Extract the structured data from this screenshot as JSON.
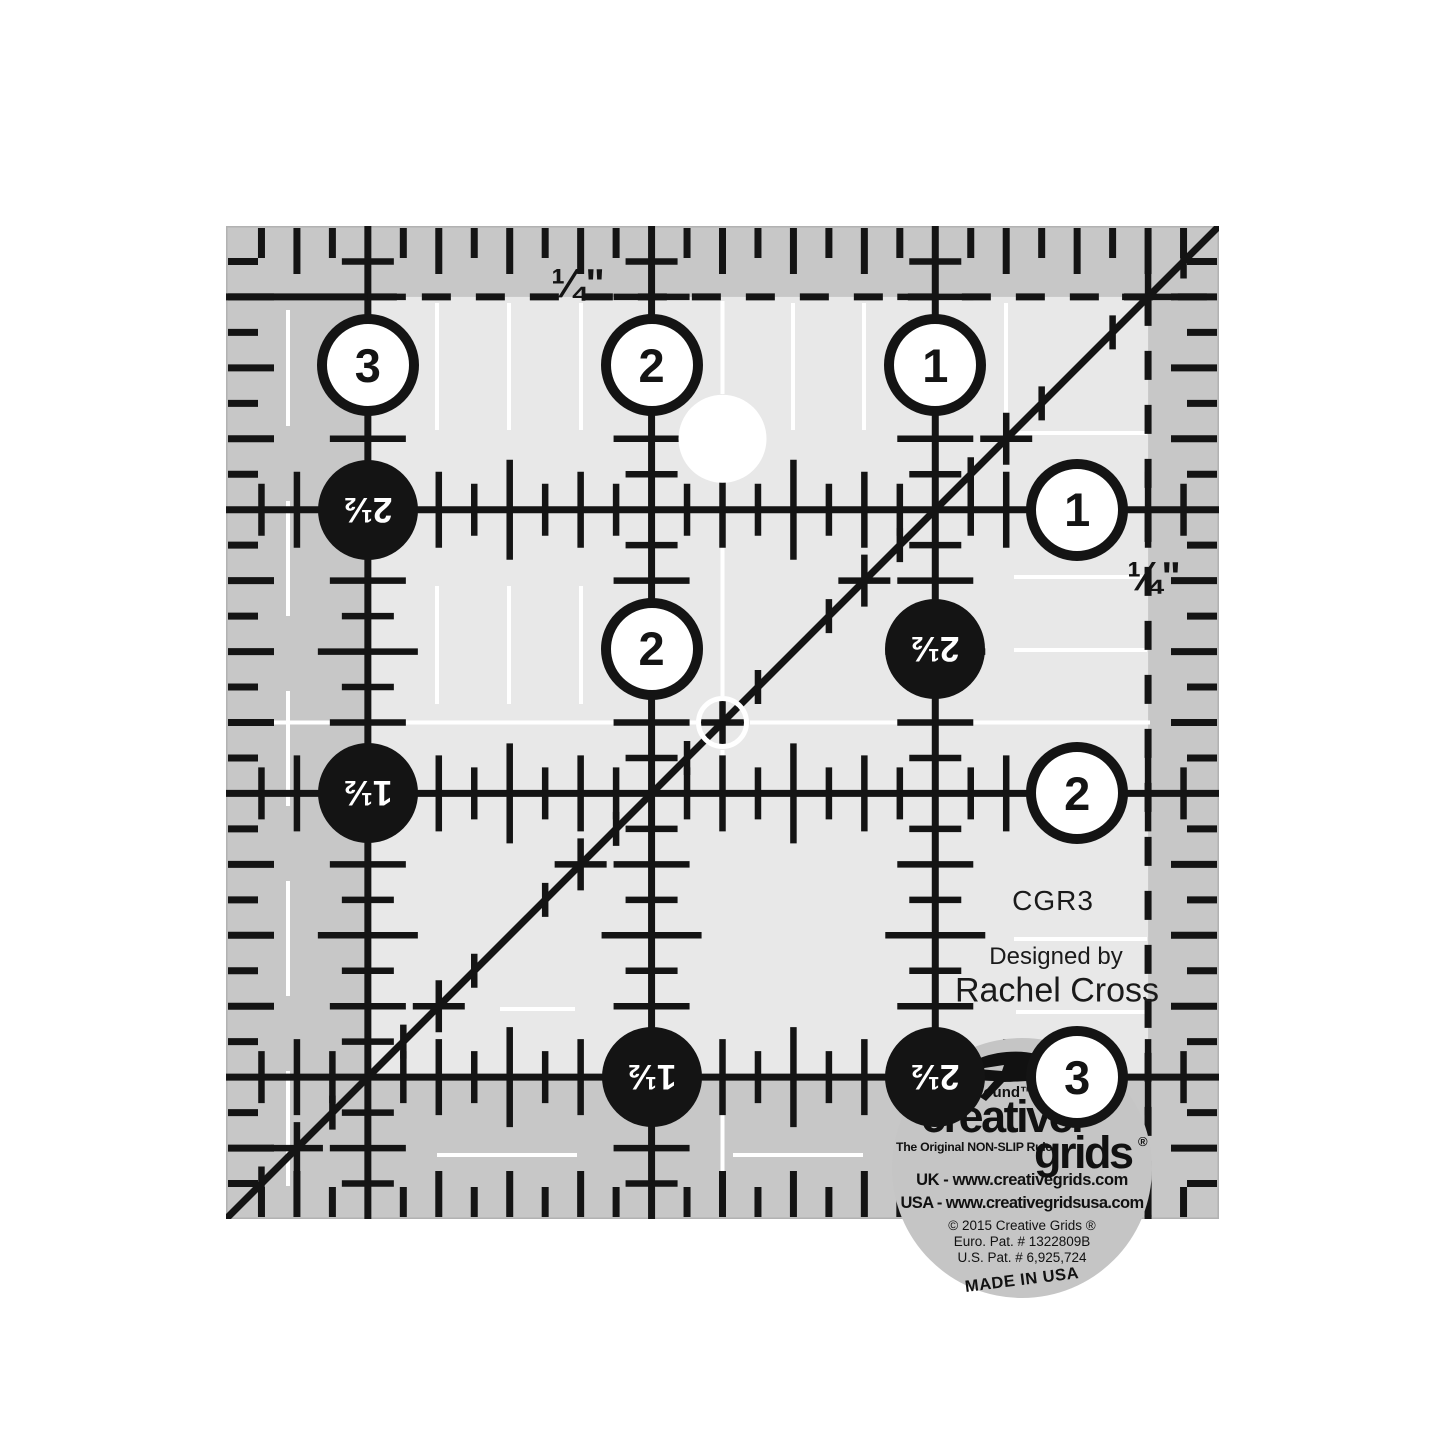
{
  "marks": {
    "quarter_top": "¼\"",
    "quarter_right": "¼\""
  },
  "corner": {
    "model": "CGR3",
    "designed_by": "Designed by",
    "designer": "Rachel Cross"
  },
  "disc": {
    "turnaround": "Turn-a-Round™",
    "brand_top": "creative.",
    "brand_bottom": "grids",
    "brand_reg": "®",
    "tagline": "The Original NON-SLIP Ruler",
    "uk_line": "UK - www.creativegrids.com",
    "usa_line": "USA - www.creativegridsusa.com",
    "copyright_line": "© 2015 Creative Grids ®",
    "euro_patent": "Euro. Pat. # 1322809B",
    "us_patent": "U.S. Pat. # 6,925,724",
    "made_in": "MADE IN USA",
    "fox_icon": "leaping-fox-logo"
  },
  "ruler": {
    "size_inches": 3.5,
    "colors": {
      "band": "#c7c7c7",
      "inner": "#e8e8e8",
      "ink": "#141414",
      "white": "#ffffff",
      "disc": "#c5c5c5",
      "edge": "#b2b2b2"
    },
    "circles": [
      {
        "label": "3",
        "style": "white",
        "x": 0.5,
        "y": 0.49
      },
      {
        "label": "2",
        "style": "white",
        "x": 1.5,
        "y": 0.49
      },
      {
        "label": "1",
        "style": "white",
        "x": 2.5,
        "y": 0.49
      },
      {
        "label": "2½",
        "style": "black",
        "x": 0.5,
        "y": 1.0
      },
      {
        "label": "1",
        "style": "white",
        "x": 3.0,
        "y": 1.0
      },
      {
        "label": "2",
        "style": "white",
        "x": 1.5,
        "y": 1.49
      },
      {
        "label": "2½",
        "style": "black",
        "x": 2.5,
        "y": 1.49
      },
      {
        "label": "1½",
        "style": "black",
        "x": 0.5,
        "y": 2.0
      },
      {
        "label": "2",
        "style": "white",
        "x": 3.0,
        "y": 2.0
      },
      {
        "label": "1½",
        "style": "black",
        "x": 1.5,
        "y": 3.0
      },
      {
        "label": "2½",
        "style": "black",
        "x": 2.5,
        "y": 3.0
      },
      {
        "label": "3",
        "style": "white",
        "x": 3.0,
        "y": 3.0
      }
    ]
  }
}
